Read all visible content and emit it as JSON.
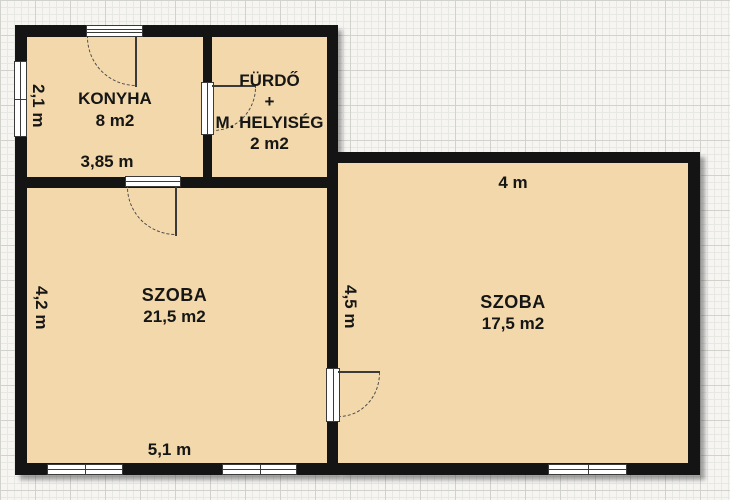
{
  "floorplan": {
    "rooms": {
      "konyha": {
        "name": "KONYHA",
        "area": "8 m2"
      },
      "furdo": {
        "name": "FÜRDŐ",
        "plus": "+",
        "name2": "M. HELYISÉG",
        "area": "2 m2"
      },
      "szoba_left": {
        "name": "SZOBA",
        "area": "21,5 m2"
      },
      "szoba_right": {
        "name": "SZOBA",
        "area": "17,5 m2"
      }
    },
    "dimensions": {
      "konyha_width": "3,85 m",
      "konyha_height": "2,1 m",
      "szoba_left_width": "5,1 m",
      "szoba_left_height": "4,2 m",
      "szoba_right_width": "4 m",
      "szoba_right_height": "4,5 m"
    },
    "colors": {
      "room_fill": "#f2d8aa",
      "wall": "#141414",
      "text": "#161616",
      "grid_minor": "#e7e7e3",
      "grid_major": "#d2d2cd",
      "paper": "#f6f5f2"
    }
  }
}
